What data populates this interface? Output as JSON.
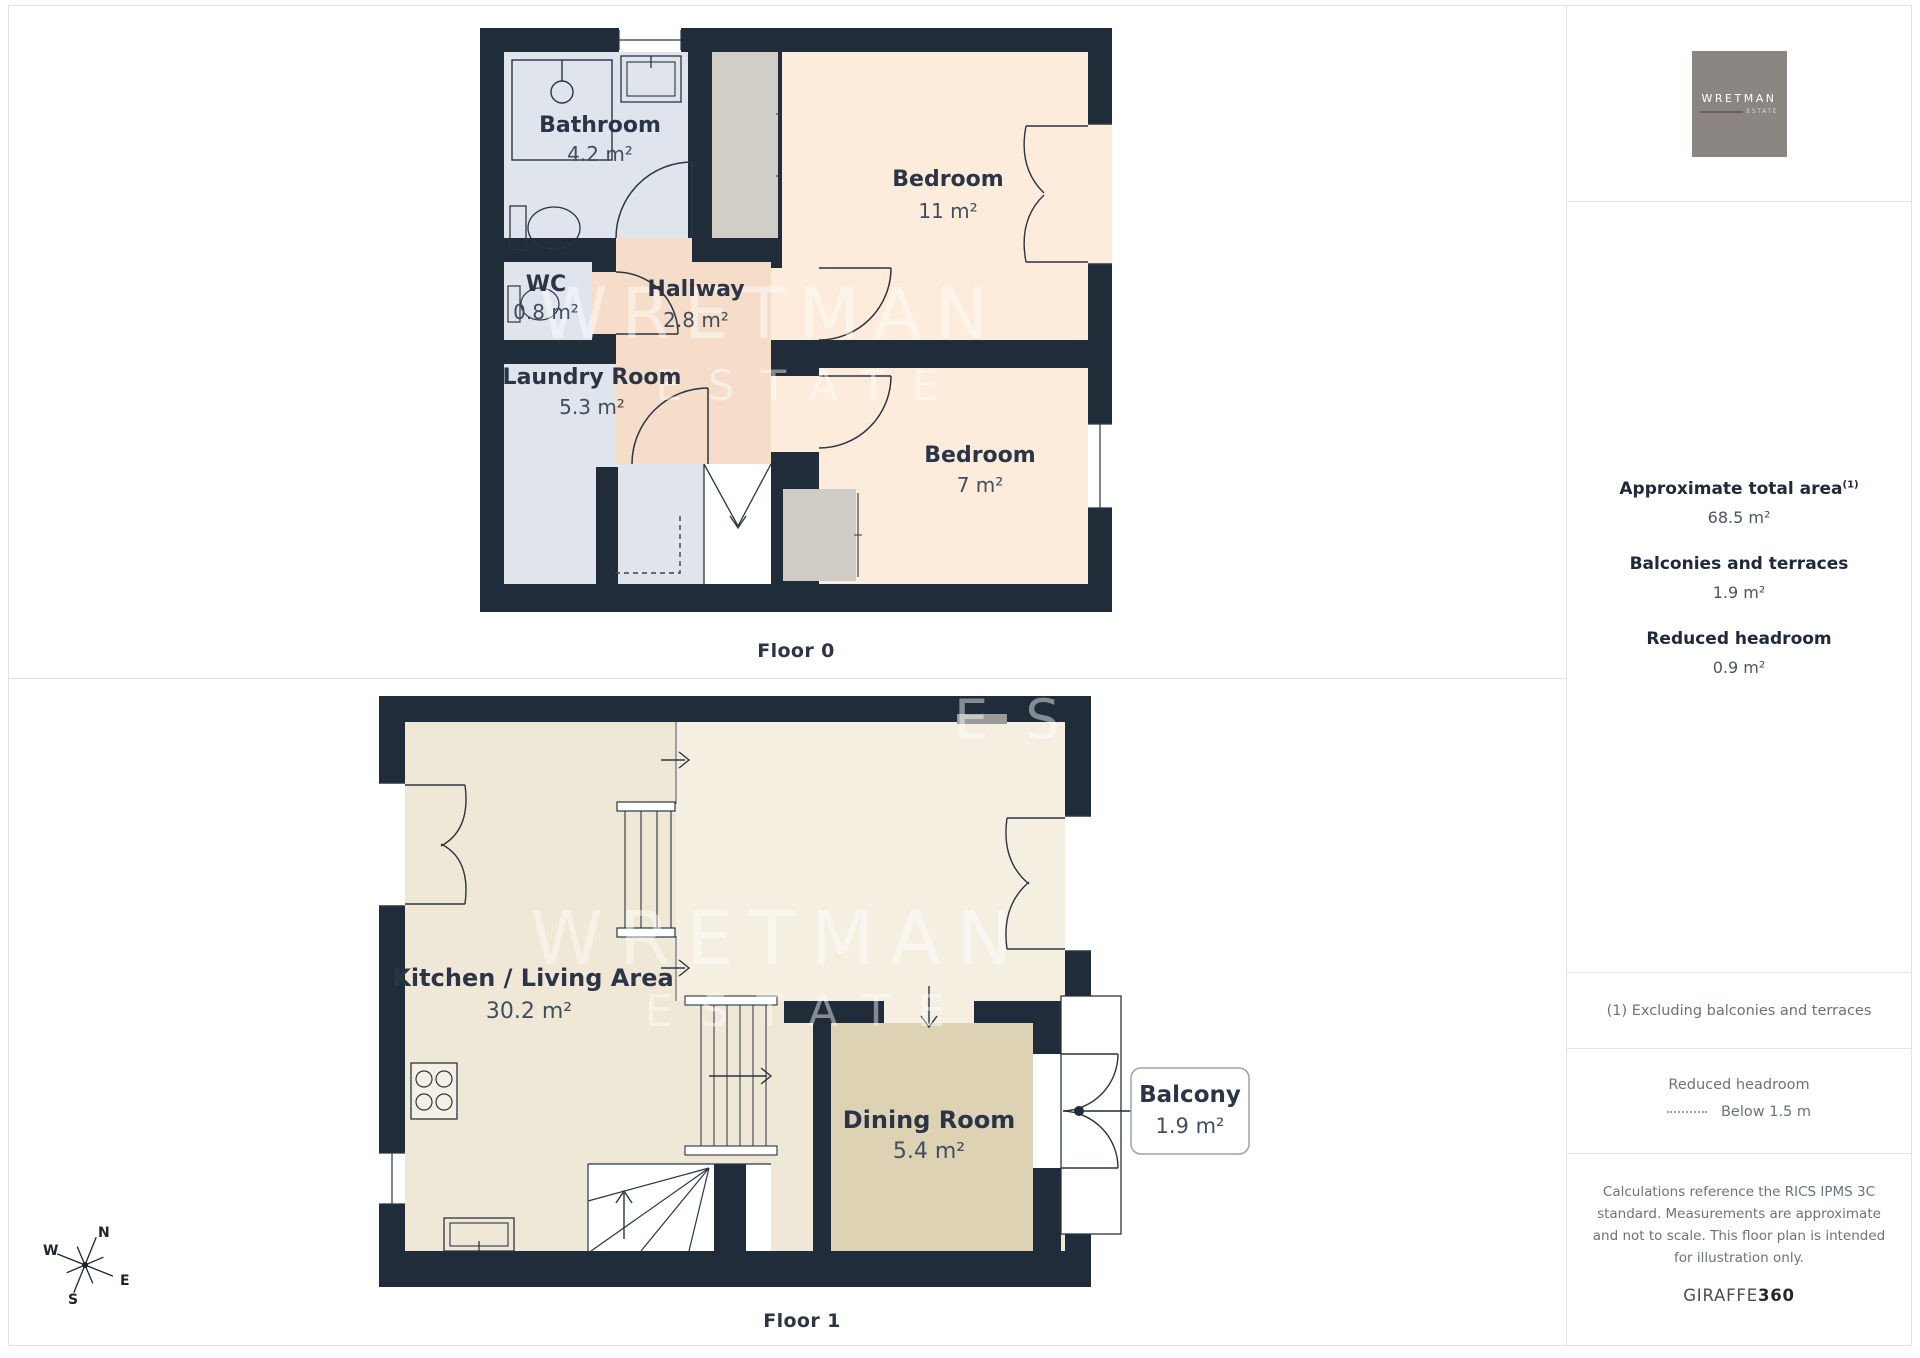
{
  "floors": [
    {
      "label": "Floor 0",
      "rooms": {
        "bathroom": {
          "name": "Bathroom",
          "area": "4.2 m²"
        },
        "wc": {
          "name": "WC",
          "area": "0.8 m²"
        },
        "hallway": {
          "name": "Hallway",
          "area": "2.8 m²"
        },
        "laundry": {
          "name": "Laundry Room",
          "area": "5.3 m²"
        },
        "bedroom_large": {
          "name": "Bedroom",
          "area": "11 m²"
        },
        "bedroom_small": {
          "name": "Bedroom",
          "area": "7 m²"
        }
      }
    },
    {
      "label": "Floor 1",
      "rooms": {
        "kitchen_living": {
          "name": "Kitchen / Living Area",
          "area": "30.2 m²"
        },
        "dining": {
          "name": "Dining Room",
          "area": "5.4 m²"
        }
      },
      "callout": {
        "name": "Balcony",
        "area": "1.9 m²"
      }
    }
  ],
  "watermark": {
    "line1": "WRETMAN",
    "line2": "ESTATE",
    "corner": "E S T"
  },
  "compass": {
    "n": "N",
    "e": "E",
    "s": "S",
    "w": "W"
  },
  "sidebar": {
    "logo": {
      "brand": "WRETMAN",
      "sub": "ESTATE"
    },
    "stats": [
      {
        "label": "Approximate total area",
        "sup": "(1)",
        "value": "68.5 m²"
      },
      {
        "label": "Balconies and terraces",
        "sup": "",
        "value": "1.9 m²"
      },
      {
        "label": "Reduced headroom",
        "sup": "",
        "value": "0.9 m²"
      }
    ],
    "note": "(1) Excluding balconies and terraces",
    "legend": {
      "title": "Reduced headroom",
      "item": "Below 1.5 m"
    },
    "disclaimer": "Calculations reference the RICS IPMS 3C standard. Measurements are approximate and not to scale. This floor plan is intended for illustration only.",
    "footer": {
      "brand": "GIRAFFE",
      "suffix": "360"
    }
  },
  "colors": {
    "wall": "#212c3b",
    "wet_rooms": "#dfe4ed",
    "hallway": "#f5ddc9",
    "bedroom": "#fdecdb",
    "closet": "#d1cec8",
    "living": "#f0e8d6",
    "upper_zone": "#f5efe2",
    "dining": "#ddd2b4"
  }
}
